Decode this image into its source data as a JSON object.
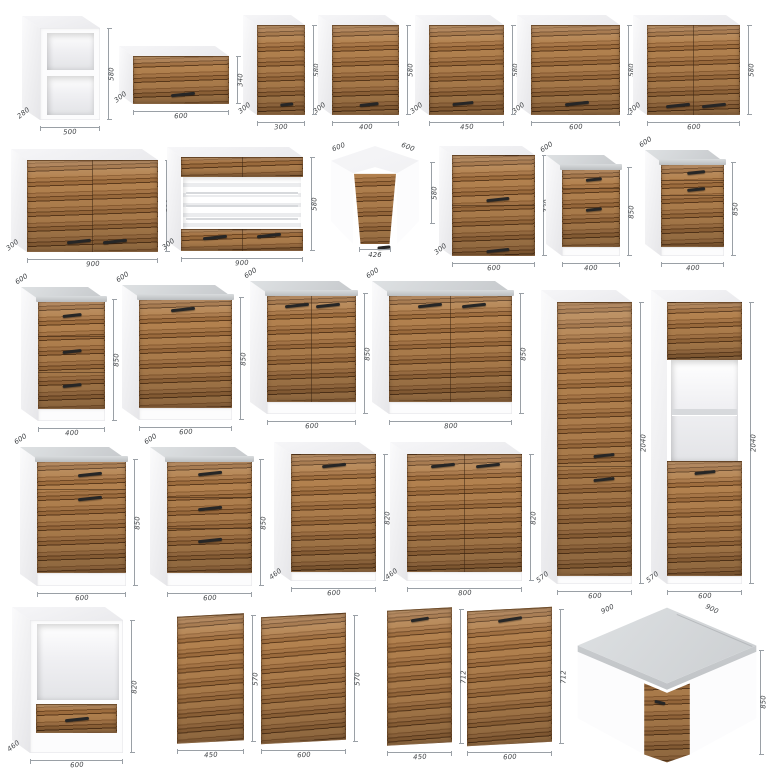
{
  "colors": {
    "wood": [
      "#b3824f",
      "#8e5f33",
      "#a87748",
      "#6f4723",
      "#9d6c3d",
      "#5c3a1c"
    ],
    "worktop_light": "#dee1e3",
    "worktop_dark": "#c6c9cc",
    "carcass": "#fcfcfd",
    "handle": "#262626",
    "dim_line": "#9aa0a6",
    "dim_text": "#3f4245"
  },
  "items": [
    {
      "name": "wall-open-shelf-unit-500",
      "type": "box",
      "top": "white",
      "depth_pos": "bl",
      "dims": {
        "w": "500",
        "h": "580",
        "d": "280"
      },
      "layout": {
        "fx": 40,
        "fy": 28,
        "fw": 60,
        "fh": 92,
        "d": 18,
        "r": 12
      },
      "panels": [
        {
          "y0": 0,
          "y1": 1,
          "k": "white"
        },
        {
          "x0": 0.12,
          "x1": 0.9,
          "y0": 0.05,
          "y1": 0.46,
          "k": "open"
        },
        {
          "x0": 0.12,
          "x1": 0.9,
          "y0": 0.52,
          "y1": 0.95,
          "k": "open"
        }
      ],
      "handles": []
    },
    {
      "name": "wall-flip-cabinet-600x340",
      "type": "box",
      "top": "white",
      "depth_pos": "bl",
      "dims": {
        "w": "600",
        "h": "340",
        "d": "300"
      },
      "layout": {
        "fx": 133,
        "fy": 56,
        "fw": 96,
        "fh": 48,
        "d": 14,
        "r": 10
      },
      "panels": [
        {
          "y0": 0,
          "y1": 1,
          "k": "wood"
        }
      ],
      "handles": [
        [
          0.52,
          0.78
        ]
      ]
    },
    {
      "name": "wall-cabinet-300",
      "type": "box",
      "top": "white",
      "depth_pos": "bl",
      "dims": {
        "w": "300",
        "h": "580",
        "d": "300"
      },
      "layout": {
        "fx": 257,
        "fy": 25,
        "fw": 48,
        "fh": 90,
        "d": 14,
        "r": 10
      },
      "panels": [
        {
          "y0": 0,
          "y1": 1,
          "k": "wood"
        }
      ],
      "handles": [
        [
          0.62,
          0.87
        ]
      ]
    },
    {
      "name": "wall-cabinet-400",
      "type": "box",
      "top": "white",
      "depth_pos": "bl",
      "dims": {
        "w": "400",
        "h": "580",
        "d": "300"
      },
      "layout": {
        "fx": 332,
        "fy": 25,
        "fw": 67,
        "fh": 90,
        "d": 14,
        "r": 10
      },
      "panels": [
        {
          "y0": 0,
          "y1": 1,
          "k": "wood"
        }
      ],
      "handles": [
        [
          0.55,
          0.87
        ]
      ]
    },
    {
      "name": "wall-cabinet-450",
      "type": "box",
      "top": "white",
      "depth_pos": "bl",
      "dims": {
        "w": "450",
        "h": "580",
        "d": "300"
      },
      "layout": {
        "fx": 429,
        "fy": 25,
        "fw": 75,
        "fh": 90,
        "d": 14,
        "r": 10
      },
      "panels": [
        {
          "y0": 0,
          "y1": 1,
          "k": "wood"
        }
      ],
      "handles": [
        [
          0.45,
          0.86
        ]
      ]
    },
    {
      "name": "wall-cabinet-600",
      "type": "box",
      "top": "white",
      "depth_pos": "bl",
      "dims": {
        "w": "600",
        "h": "580",
        "d": "300"
      },
      "layout": {
        "fx": 531,
        "fy": 25,
        "fw": 89,
        "fh": 90,
        "d": 14,
        "r": 10
      },
      "panels": [
        {
          "y0": 0,
          "y1": 1,
          "k": "wood"
        }
      ],
      "handles": [
        [
          0.52,
          0.86
        ]
      ]
    },
    {
      "name": "wall-cabinet-2door-600",
      "type": "box",
      "top": "white",
      "depth_pos": "bl",
      "dims": {
        "w": "600",
        "h": "580",
        "d": "300"
      },
      "layout": {
        "fx": 647,
        "fy": 25,
        "fw": 93,
        "fh": 90,
        "d": 14,
        "r": 10
      },
      "panels": [
        {
          "y0": 0,
          "y1": 1,
          "k": "wood"
        }
      ],
      "vsplits": [
        [
          0.5,
          0,
          1
        ]
      ],
      "handles": [
        [
          0.33,
          0.88
        ],
        [
          0.72,
          0.88
        ]
      ]
    },
    {
      "name": "wall-cabinet-2door-900",
      "type": "box",
      "top": "white",
      "depth_pos": "bl",
      "dims": {
        "w": "900",
        "h": "580",
        "d": "300"
      },
      "layout": {
        "fx": 27,
        "fy": 160,
        "fw": 131,
        "fh": 92,
        "d": 16,
        "r": 11
      },
      "panels": [
        {
          "y0": 0,
          "y1": 1,
          "k": "wood"
        }
      ],
      "vsplits": [
        [
          0.5,
          0,
          1
        ]
      ],
      "handles": [
        [
          0.4,
          0.87
        ],
        [
          0.67,
          0.87
        ]
      ]
    },
    {
      "name": "wall-display-cabinet-900",
      "type": "box",
      "top": "white",
      "depth_pos": "bl",
      "dims": {
        "w": "900",
        "h": "580",
        "d": "300"
      },
      "layout": {
        "fx": 181,
        "fy": 157,
        "fw": 122,
        "fh": 94,
        "d": 14,
        "r": 10
      },
      "panels": [
        {
          "y0": 0,
          "y1": 0.21,
          "k": "wood"
        },
        {
          "x0": 0.02,
          "x1": 0.98,
          "y0": 0.21,
          "y1": 0.77,
          "k": "open-striped"
        },
        {
          "x0": 0.04,
          "x1": 0.96,
          "y0": 0.37,
          "y1": 0.395,
          "k": "shelf"
        },
        {
          "x0": 0.04,
          "x1": 0.96,
          "y0": 0.51,
          "y1": 0.535,
          "k": "shelf"
        },
        {
          "x0": 0.04,
          "x1": 0.96,
          "y0": 0.645,
          "y1": 0.67,
          "k": "shelf"
        },
        {
          "y0": 0.77,
          "y1": 1,
          "k": "wood"
        }
      ],
      "vsplits": [
        [
          0.5,
          0,
          0.21
        ],
        [
          0.5,
          0.77,
          1
        ]
      ],
      "handles": [
        [
          0.28,
          0.84
        ],
        [
          0.72,
          0.82
        ]
      ]
    },
    {
      "name": "corner-wall-cabinet-600",
      "type": "corner-wall",
      "dims": {
        "w1": "600",
        "w2": "600",
        "h": "580",
        "door": "426"
      },
      "layout": {
        "x": 325,
        "y": 146,
        "w": 100,
        "h": 114
      },
      "handles": [
        [
          0.5,
          0.79
        ]
      ]
    },
    {
      "name": "wall-cabinet-600x720",
      "type": "box",
      "top": "white",
      "depth_pos": "bl",
      "dims": {
        "w": "600",
        "h": "720",
        "d": "300"
      },
      "layout": {
        "fx": 452,
        "fy": 155,
        "fw": 83,
        "fh": 101,
        "d": 13,
        "r": 9
      },
      "panels": [
        {
          "y0": 0,
          "y1": 1,
          "k": "wood"
        }
      ],
      "hsplits": [
        [
          0.5,
          0,
          1
        ]
      ],
      "handles": [
        [
          0.56,
          0.43
        ],
        [
          0.56,
          0.93
        ]
      ]
    },
    {
      "name": "base-cabinet-drawer-door-400",
      "type": "box",
      "top": "worktop",
      "depth_pos": "tl",
      "dims": {
        "w": "400",
        "h": "850",
        "d": "600"
      },
      "layout": {
        "fx": 562,
        "fy": 167,
        "fw": 58,
        "fh": 89,
        "d": 16,
        "r": 12
      },
      "panels": [
        {
          "y0": 0,
          "y1": 0.9,
          "k": "wood"
        },
        {
          "y0": 0.9,
          "y1": 1,
          "k": "white"
        }
      ],
      "hsplits": [
        [
          0.24,
          0,
          1
        ]
      ],
      "handles": [
        [
          0.56,
          0.12
        ],
        [
          0.56,
          0.46
        ]
      ]
    },
    {
      "name": "base-cabinet-2drawer-door-400",
      "type": "box",
      "top": "worktop",
      "depth_pos": "tl",
      "dims": {
        "w": "400",
        "h": "850",
        "d": "600"
      },
      "layout": {
        "fx": 661,
        "fy": 162,
        "fw": 63,
        "fh": 94,
        "d": 16,
        "r": 12
      },
      "panels": [
        {
          "y0": 0,
          "y1": 0.9,
          "k": "wood"
        },
        {
          "y0": 0.9,
          "y1": 1,
          "k": "white"
        }
      ],
      "hsplits": [
        [
          0.2,
          0,
          1
        ],
        [
          0.36,
          0,
          1
        ]
      ],
      "handles": [
        [
          0.56,
          0.1
        ],
        [
          0.56,
          0.28
        ]
      ]
    },
    {
      "name": "base-cabinet-3drawer-400",
      "type": "box",
      "top": "worktop",
      "depth_pos": "tl",
      "dims": {
        "w": "400",
        "h": "850",
        "d": "600"
      },
      "layout": {
        "fx": 38,
        "fy": 299,
        "fw": 67,
        "fh": 122,
        "d": 17,
        "r": 12
      },
      "panels": [
        {
          "y0": 0,
          "y1": 0.9,
          "k": "wood"
        },
        {
          "y0": 0.9,
          "y1": 1,
          "k": "white"
        }
      ],
      "hsplits": [
        [
          0.31,
          0,
          1
        ],
        [
          0.6,
          0,
          1
        ]
      ],
      "handles": [
        [
          0.5,
          0.12
        ],
        [
          0.5,
          0.42
        ],
        [
          0.5,
          0.7
        ]
      ]
    },
    {
      "name": "base-cabinet-600",
      "type": "box",
      "top": "worktop",
      "depth_pos": "tl",
      "dims": {
        "w": "600",
        "h": "850",
        "d": "600"
      },
      "layout": {
        "fx": 139,
        "fy": 297,
        "fw": 93,
        "fh": 123,
        "d": 17,
        "r": 12
      },
      "panels": [
        {
          "y0": 0,
          "y1": 0.9,
          "k": "wood"
        },
        {
          "y0": 0.9,
          "y1": 1,
          "k": "white"
        }
      ],
      "handles": [
        [
          0.47,
          0.09
        ]
      ]
    },
    {
      "name": "base-cabinet-2door-600",
      "type": "box",
      "top": "worktop",
      "depth_pos": "tl",
      "dims": {
        "w": "600",
        "h": "850",
        "d": "600"
      },
      "layout": {
        "fx": 267,
        "fy": 293,
        "fw": 89,
        "fh": 121,
        "d": 17,
        "r": 12
      },
      "panels": [
        {
          "y0": 0,
          "y1": 0.9,
          "k": "wood"
        },
        {
          "y0": 0.9,
          "y1": 1,
          "k": "white"
        }
      ],
      "vsplits": [
        [
          0.5,
          0,
          0.9
        ]
      ],
      "handles": [
        [
          0.34,
          0.09
        ],
        [
          0.68,
          0.09
        ]
      ]
    },
    {
      "name": "base-cabinet-2door-800",
      "type": "box",
      "top": "worktop",
      "depth_pos": "tl",
      "dims": {
        "w": "800",
        "h": "850",
        "d": "600"
      },
      "layout": {
        "fx": 389,
        "fy": 293,
        "fw": 123,
        "fh": 121,
        "d": 17,
        "r": 12
      },
      "panels": [
        {
          "y0": 0,
          "y1": 0.9,
          "k": "wood"
        },
        {
          "y0": 0.9,
          "y1": 1,
          "k": "white"
        }
      ],
      "vsplits": [
        [
          0.5,
          0,
          0.9
        ]
      ],
      "handles": [
        [
          0.33,
          0.09
        ],
        [
          0.69,
          0.09
        ]
      ]
    },
    {
      "name": "tall-pantry-600",
      "type": "box",
      "top": "white",
      "depth_pos": "bl",
      "dims": {
        "w": "600",
        "h": "2040",
        "d": "570"
      },
      "layout": {
        "fx": 557,
        "fy": 302,
        "fw": 75,
        "fh": 282,
        "d": 16,
        "r": 12
      },
      "panels": [
        {
          "y0": 0,
          "y1": 0.97,
          "k": "wood"
        },
        {
          "y0": 0.97,
          "y1": 1,
          "k": "white"
        }
      ],
      "hsplits": [
        [
          0.585,
          0,
          1
        ]
      ],
      "handles": [
        [
          0.63,
          0.54
        ],
        [
          0.63,
          0.625
        ]
      ]
    },
    {
      "name": "tall-oven-housing-600",
      "type": "box",
      "top": "white",
      "depth_pos": "bl",
      "dims": {
        "w": "600",
        "h": "2040",
        "d": "570"
      },
      "layout": {
        "fx": 667,
        "fy": 302,
        "fw": 75,
        "fh": 282,
        "d": 16,
        "r": 12
      },
      "panels": [
        {
          "y0": 0,
          "y1": 0.205,
          "k": "wood"
        },
        {
          "x0": 0.05,
          "x1": 0.95,
          "y0": 0.205,
          "y1": 0.565,
          "k": "open"
        },
        {
          "x0": 0.07,
          "x1": 0.93,
          "y0": 0.38,
          "y1": 0.4,
          "k": "shelf"
        },
        {
          "y0": 0.565,
          "y1": 0.97,
          "k": "wood"
        },
        {
          "y0": 0.97,
          "y1": 1,
          "k": "white"
        }
      ],
      "handles": [
        [
          0.5,
          0.6
        ]
      ]
    },
    {
      "name": "base-cabinet-drawer-door-600",
      "type": "box",
      "top": "worktop",
      "depth_pos": "tl",
      "dims": {
        "w": "600",
        "h": "850",
        "d": "600"
      },
      "layout": {
        "fx": 37,
        "fy": 459,
        "fw": 89,
        "fh": 127,
        "d": 17,
        "r": 12
      },
      "panels": [
        {
          "y0": 0,
          "y1": 0.9,
          "k": "wood"
        },
        {
          "y0": 0.9,
          "y1": 1,
          "k": "white"
        }
      ],
      "hsplits": [
        [
          0.24,
          0,
          1
        ]
      ],
      "handles": [
        [
          0.6,
          0.11
        ],
        [
          0.6,
          0.3
        ]
      ]
    },
    {
      "name": "base-cabinet-3drawer-600",
      "type": "box",
      "top": "worktop",
      "depth_pos": "tl",
      "dims": {
        "w": "600",
        "h": "850",
        "d": "600"
      },
      "layout": {
        "fx": 167,
        "fy": 459,
        "fw": 85,
        "fh": 127,
        "d": 17,
        "r": 12
      },
      "panels": [
        {
          "y0": 0,
          "y1": 0.9,
          "k": "wood"
        },
        {
          "y0": 0.9,
          "y1": 1,
          "k": "white"
        }
      ],
      "hsplits": [
        [
          0.3,
          0,
          1
        ],
        [
          0.55,
          0,
          1
        ]
      ],
      "handles": [
        [
          0.5,
          0.1
        ],
        [
          0.5,
          0.38
        ],
        [
          0.5,
          0.63
        ]
      ]
    },
    {
      "name": "base-cabinet-no-top-600",
      "type": "box",
      "top": "white",
      "depth_pos": "bl",
      "dims": {
        "w": "600",
        "h": "820",
        "d": "460"
      },
      "layout": {
        "fx": 291,
        "fy": 454,
        "fw": 85,
        "fh": 127,
        "d": 17,
        "r": 12
      },
      "panels": [
        {
          "y0": 0,
          "y1": 0.93,
          "k": "wood"
        },
        {
          "y0": 0.93,
          "y1": 1,
          "k": "white"
        }
      ],
      "handles": [
        [
          0.5,
          0.08
        ]
      ]
    },
    {
      "name": "base-cabinet-no-top-2door-800",
      "type": "box",
      "top": "white",
      "depth_pos": "bl",
      "dims": {
        "w": "800",
        "h": "820",
        "d": "460"
      },
      "layout": {
        "fx": 407,
        "fy": 454,
        "fw": 115,
        "fh": 127,
        "d": 17,
        "r": 12
      },
      "panels": [
        {
          "y0": 0,
          "y1": 0.93,
          "k": "wood"
        },
        {
          "y0": 0.93,
          "y1": 1,
          "k": "white"
        }
      ],
      "vsplits": [
        [
          0.5,
          0,
          0.93
        ]
      ],
      "handles": [
        [
          0.31,
          0.08
        ],
        [
          0.7,
          0.08
        ]
      ]
    },
    {
      "name": "oven-housing-base-600",
      "type": "box",
      "top": "white",
      "depth_pos": "bl",
      "dims": {
        "w": "600",
        "h": "820",
        "d": "460"
      },
      "layout": {
        "fx": 30,
        "fy": 620,
        "fw": 93,
        "fh": 133,
        "d": 18,
        "r": 13
      },
      "panels": [
        {
          "y0": 0,
          "y1": 1,
          "k": "white"
        },
        {
          "x0": 0.08,
          "x1": 0.96,
          "y0": 0.03,
          "y1": 0.6,
          "k": "open"
        },
        {
          "x0": 0.06,
          "x1": 0.94,
          "y0": 0.63,
          "y1": 0.85,
          "k": "wood"
        }
      ],
      "handles": [
        [
          0.5,
          0.74
        ]
      ]
    },
    {
      "name": "front-panel-450x570",
      "type": "panel",
      "dims": {
        "w": "450",
        "h": "570"
      },
      "layout": {
        "fx": 177,
        "fy": 615,
        "fw": 67,
        "fh": 127
      },
      "panels": [
        {
          "y0": 0,
          "y1": 1,
          "k": "wood"
        }
      ],
      "handles": []
    },
    {
      "name": "front-panel-600x570",
      "type": "panel",
      "dims": {
        "w": "600",
        "h": "570"
      },
      "layout": {
        "fx": 261,
        "fy": 615,
        "fw": 85,
        "fh": 127
      },
      "panels": [
        {
          "y0": 0,
          "y1": 1,
          "k": "wood"
        }
      ],
      "handles": []
    },
    {
      "name": "front-panel-450x712",
      "type": "panel",
      "dims": {
        "w": "450",
        "h": "712"
      },
      "layout": {
        "fx": 387,
        "fy": 609,
        "fw": 65,
        "fh": 135
      },
      "panels": [
        {
          "y0": 0,
          "y1": 1,
          "k": "wood"
        }
      ],
      "handles": [
        [
          0.5,
          0.07
        ]
      ]
    },
    {
      "name": "front-panel-600x712",
      "type": "panel",
      "dims": {
        "w": "600",
        "h": "712"
      },
      "layout": {
        "fx": 467,
        "fy": 609,
        "fw": 85,
        "fh": 135
      },
      "panels": [
        {
          "y0": 0,
          "y1": 1,
          "k": "wood"
        }
      ],
      "handles": [
        [
          0.5,
          0.07
        ]
      ]
    },
    {
      "name": "corner-base-cabinet-900",
      "type": "corner-base",
      "dims": {
        "w1": "900",
        "w2": "900",
        "h": "850"
      },
      "layout": {
        "x": 572,
        "y": 606,
        "w": 190,
        "h": 158
      },
      "handles": [
        [
          0.43,
          0.57
        ]
      ]
    }
  ]
}
